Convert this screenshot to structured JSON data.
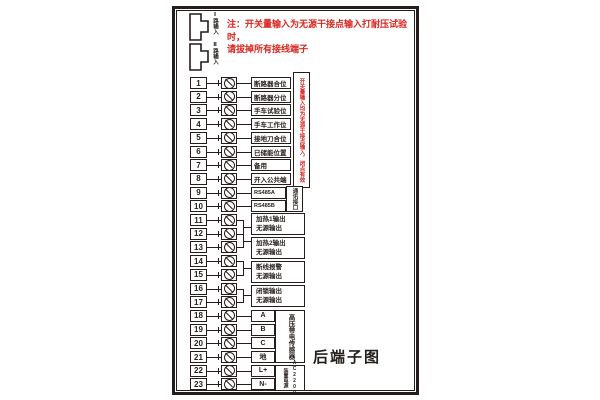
{
  "caption": "后端子图",
  "warning_note": {
    "line1": "注：开关量输入为无源干接点输入打耐压试验时，",
    "line2": "请拔掉所有接线端子"
  },
  "connectors": [
    {
      "label": "Ⅰ路输入"
    },
    {
      "label": "Ⅱ路输入"
    }
  ],
  "terminals": [
    {
      "no": "1",
      "label": "断路器合位",
      "style": "wide"
    },
    {
      "no": "2",
      "label": "断路器分位",
      "style": "wide"
    },
    {
      "no": "3",
      "label": "手车试验位",
      "style": "wide"
    },
    {
      "no": "4",
      "label": "手车工作位",
      "style": "wide"
    },
    {
      "no": "5",
      "label": "接地刀合位",
      "style": "wide"
    },
    {
      "no": "6",
      "label": "已储能位置",
      "style": "wide"
    },
    {
      "no": "7",
      "label": "备用",
      "style": "wide"
    },
    {
      "no": "8",
      "label": "开入公共端",
      "style": "wide"
    },
    {
      "no": "9",
      "label": "RS485A",
      "style": "narrow"
    },
    {
      "no": "10",
      "label": "RS485B",
      "style": "narrow"
    },
    {
      "no": "11",
      "label": "",
      "style": "group"
    },
    {
      "no": "12",
      "label": "",
      "style": "group"
    },
    {
      "no": "13",
      "label": "",
      "style": "group"
    },
    {
      "no": "14",
      "label": "",
      "style": "group"
    },
    {
      "no": "15",
      "label": "",
      "style": "group"
    },
    {
      "no": "16",
      "label": "",
      "style": "group"
    },
    {
      "no": "17",
      "label": "",
      "style": "group"
    },
    {
      "no": "18",
      "label": "A",
      "style": "small"
    },
    {
      "no": "19",
      "label": "B",
      "style": "small"
    },
    {
      "no": "20",
      "label": "C",
      "style": "small"
    },
    {
      "no": "21",
      "label": "地",
      "style": "small"
    },
    {
      "no": "22",
      "label": "L+",
      "style": "small"
    },
    {
      "no": "23",
      "label": "N-",
      "style": "small"
    }
  ],
  "output_groups": [
    {
      "rows": [
        11,
        12
      ],
      "title": "加热1输出",
      "sub": "无源输出"
    },
    {
      "rows": [
        12,
        13
      ],
      "title": "加热2输出",
      "sub": "无源输出"
    },
    {
      "rows": [
        14,
        15
      ],
      "title": "断线报警",
      "sub": "无源输出"
    },
    {
      "rows": [
        16,
        17
      ],
      "title": "闭锁输出",
      "sub": "无源输出"
    }
  ],
  "side_notes": {
    "di_note": "开关量输入均为无源干接点输入，闭点有效",
    "comm": "通讯接口",
    "sensor": "高压带电传感器",
    "power_name": "装置电源",
    "power_rating": "AC220V"
  },
  "colors": {
    "line": "#241d1b",
    "warning_red": "#d9251f"
  }
}
